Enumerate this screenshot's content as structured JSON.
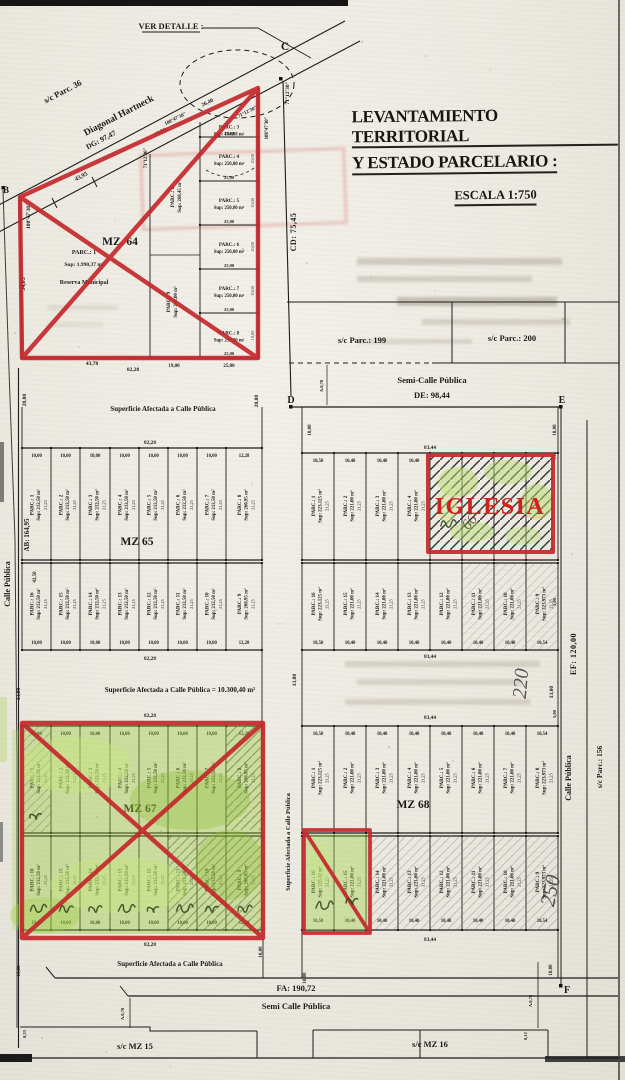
{
  "title": {
    "line1": "LEVANTAMIENTO TERRITORIAL",
    "line2": "Y ESTADO PARCELARIO :",
    "scale": "ESCALA 1:750"
  },
  "corners": {
    "b": "B",
    "c": "C",
    "d": "D",
    "e": "E",
    "f": "F"
  },
  "streets": {
    "ver_detalle": "VER DETALLE :",
    "sc_parc_36": "s/c Parc. 36",
    "diagonal_hartneck": "Diagonal Hartneck",
    "dg": "DG: 97,47",
    "cd": "CD: 75,45",
    "de_name": "Semi-Calle Pública",
    "de": "DE: 98,44",
    "ef": "EF: 120,00",
    "fa": "FA: 190,72",
    "fa_name": "Semi Calle Pública",
    "ab": "AB: 164,95",
    "calle_publica_left": "Calle Pública",
    "calle_publica_right": "Calle Pública",
    "sc_parc_156": "s/c Parc.: 156",
    "sc_parc_199": "s/c Parc.: 199",
    "sc_parc_200": "s/c Parc.: 200",
    "sc_mz_15": "s/c MZ 15",
    "sc_mz_16": "s/c MZ 16",
    "sup_calle_1": "Superficie Afectada a Calle Pública",
    "sup_calle_total": "Superficie Afectada a Calle Pública = 10.300,40 m²",
    "sup_calle_2": "Superficie Afectada a Calle Pública",
    "sup_calle_vert": "Superficie Afectada a Calle Pública"
  },
  "annotations": {
    "iglesia": "IGLESIA",
    "hw_220": "220",
    "hw_250": "250",
    "hw_66": "66"
  },
  "mz64": {
    "label": "MZ. 64",
    "parc1_name": "PARC.: 1",
    "parc1_sup": "Sup: 1.990,37 m²",
    "parc1_note": "Reserva Municipal",
    "strip_top": {
      "n": "PARC.: 2",
      "s": "Sup: 268,45 m²"
    },
    "strip_bottom": {
      "n": "PARC.: 9",
      "s": "Sup: 250,00 m²"
    },
    "column": [
      {
        "n": "PARC.: 3",
        "s": "Sup: 194,88 m²"
      },
      {
        "n": "PARC.: 4",
        "s": "Sup: 250,00 m²"
      },
      {
        "n": "PARC.: 5",
        "s": "Sup: 250,00 m²"
      },
      {
        "n": "PARC.: 6",
        "s": "Sup: 250,00 m²"
      },
      {
        "n": "PARC.: 7",
        "s": "Sup: 250,00 m²"
      },
      {
        "n": "PARC.: 8",
        "s": "Sup: 250,00 m²"
      }
    ],
    "width_label": "25,00",
    "depth_label": "10,00"
  },
  "blocks": {
    "mz65": {
      "label": "MZ 65",
      "height_label": "21,25",
      "top_total": "82,28",
      "bottom_total": "82,28",
      "rows": [
        {
          "widths": [
            "10,00",
            "10,00",
            "10,00",
            "10,00",
            "10,00",
            "10,00",
            "10,00",
            "12,28"
          ],
          "parcels": [
            {
              "n": "PARC.: 1",
              "s": "Sup: 212,50 m²"
            },
            {
              "n": "PARC.: 2",
              "s": "Sup: 212,50 m²"
            },
            {
              "n": "PARC.: 3",
              "s": "Sup: 212,50 m²"
            },
            {
              "n": "PARC.: 4",
              "s": "Sup: 212,50 m²"
            },
            {
              "n": "PARC.: 5",
              "s": "Sup: 212,50 m²"
            },
            {
              "n": "PARC.: 6",
              "s": "Sup: 212,50 m²"
            },
            {
              "n": "PARC.: 7",
              "s": "Sup: 212,50 m²"
            },
            {
              "n": "PARC.: 8",
              "s": "Sup: 260,95 m²"
            }
          ]
        },
        {
          "widths": [
            "10,00",
            "10,00",
            "10,00",
            "10,00",
            "10,00",
            "10,00",
            "10,00",
            "12,28"
          ],
          "parcels": [
            {
              "n": "PARC.: 16",
              "s": "Sup: 212,50 m²"
            },
            {
              "n": "PARC.: 15",
              "s": "Sup: 212,50 m²"
            },
            {
              "n": "PARC.: 14",
              "s": "Sup: 212,50 m²"
            },
            {
              "n": "PARC.: 13",
              "s": "Sup: 212,50 m²"
            },
            {
              "n": "PARC.: 12",
              "s": "Sup: 212,50 m²"
            },
            {
              "n": "PARC.: 11",
              "s": "Sup: 212,50 m²"
            },
            {
              "n": "PARC.: 10",
              "s": "Sup: 212,50 m²"
            },
            {
              "n": "PARC.: 9",
              "s": "Sup: 260,95 m²"
            }
          ]
        }
      ]
    },
    "mz66": {
      "label": "",
      "height_label": "21,25",
      "top_total": "83,44",
      "bottom_total": "83,44",
      "rows": [
        {
          "widths": [
            "10,50",
            "10,40",
            "10,40",
            "10,40"
          ],
          "parcels": [
            {
              "n": "PARC.: 1",
              "s": "Sup: 223,125 m²"
            },
            {
              "n": "PARC.: 2",
              "s": "Sup: 221,00 m²"
            },
            {
              "n": "PARC.: 3",
              "s": "Sup: 221,00 m²"
            },
            {
              "n": "PARC.: 4",
              "s": "Sup: 221,00 m²"
            },
            {
              "n": "",
              "s": ""
            },
            {
              "n": "",
              "s": ""
            },
            {
              "n": "",
              "s": ""
            },
            {
              "n": "",
              "s": ""
            }
          ]
        },
        {
          "widths": [
            "10,50",
            "10,40",
            "10,40",
            "10,40",
            "10,40",
            "10,40",
            "10,40",
            "10,54"
          ],
          "parcels": [
            {
              "n": "PARC.: 16",
              "s": "Sup: 223,125 m²"
            },
            {
              "n": "PARC.: 15",
              "s": "Sup: 221,00 m²"
            },
            {
              "n": "PARC.: 14",
              "s": "Sup: 221,00 m²"
            },
            {
              "n": "PARC.: 13",
              "s": "Sup: 221,00 m²"
            },
            {
              "n": "PARC.: 12",
              "s": "Sup: 221,00 m²"
            },
            {
              "n": "PARC.: 11",
              "s": "Sup: 221,00 m²"
            },
            {
              "n": "PARC.: 10",
              "s": "Sup: 221,00 m²"
            },
            {
              "n": "PARC.: 9",
              "s": "Sup: 223,973 m²"
            }
          ]
        }
      ]
    },
    "mz67": {
      "label": "MZ 67",
      "height_label": "21,25",
      "top_total": "82,28",
      "bottom_total": "82,28",
      "rows": [
        {
          "widths": [
            "10,00",
            "10,00",
            "10,00",
            "10,00",
            "10,00",
            "10,00",
            "10,00",
            "12,28"
          ],
          "parcels": [
            {
              "n": "PARC.: 1",
              "s": "Sup: 212,50 m²"
            },
            {
              "n": "PARC.: 2",
              "s": "Sup: 212,50 m²"
            },
            {
              "n": "PARC.: 3",
              "s": "Sup: 212,50 m²"
            },
            {
              "n": "PARC.: 4",
              "s": "Sup: 212,50 m²"
            },
            {
              "n": "PARC.: 5",
              "s": "Sup: 212,50 m²"
            },
            {
              "n": "PARC.: 6",
              "s": "Sup: 212,50 m²"
            },
            {
              "n": "PARC.: 7",
              "s": "Sup: 212,50 m²"
            },
            {
              "n": "PARC.: 8",
              "s": "Sup: 260,95 m²"
            }
          ]
        },
        {
          "widths": [
            "10,00",
            "10,00",
            "10,00",
            "10,00",
            "10,00",
            "10,00",
            "10,00",
            "12,28"
          ],
          "parcels": [
            {
              "n": "PARC.: 16",
              "s": "Sup: 212,50 m²"
            },
            {
              "n": "PARC.: 15",
              "s": "Sup: 212,50 m²"
            },
            {
              "n": "PARC.: 14",
              "s": "Sup: 212,50 m²"
            },
            {
              "n": "PARC.: 13",
              "s": "Sup: 212,50 m²"
            },
            {
              "n": "PARC.: 12",
              "s": "Sup: 212,50 m²"
            },
            {
              "n": "PARC.: 11",
              "s": "Sup: 212,50 m²"
            },
            {
              "n": "PARC.: 10",
              "s": "Sup: 212,50 m²"
            },
            {
              "n": "PARC.: 9",
              "s": "Sup: 260,95 m²"
            }
          ]
        }
      ]
    },
    "mz68": {
      "label": "MZ 68",
      "height_label": "21,25",
      "top_total": "83,44",
      "bottom_total": "83,44",
      "rows": [
        {
          "widths": [
            "10,50",
            "10,40",
            "10,40",
            "10,40",
            "10,40",
            "10,40",
            "10,40",
            "10,54"
          ],
          "parcels": [
            {
              "n": "PARC.: 1",
              "s": "Sup: 223,125 m²"
            },
            {
              "n": "PARC.: 2",
              "s": "Sup: 221,00 m²"
            },
            {
              "n": "PARC.: 3",
              "s": "Sup: 221,00 m²"
            },
            {
              "n": "PARC.: 4",
              "s": "Sup: 221,00 m²"
            },
            {
              "n": "PARC.: 5",
              "s": "Sup: 221,00 m²"
            },
            {
              "n": "PARC.: 6",
              "s": "Sup: 221,00 m²"
            },
            {
              "n": "PARC.: 7",
              "s": "Sup: 221,00 m²"
            },
            {
              "n": "PARC.: 8",
              "s": "Sup: 223,973 m²"
            }
          ]
        },
        {
          "widths": [
            "10,50",
            "10,40",
            "10,40",
            "10,40",
            "10,40",
            "10,40",
            "10,40",
            "10,54"
          ],
          "parcels": [
            {
              "n": "PARC.: 16",
              "s": "Sup: 223,12 m²"
            },
            {
              "n": "PARC.: 15",
              "s": "Sup: 221,00 m²"
            },
            {
              "n": "PARC.: 14",
              "s": "Sup: 221,00 m²"
            },
            {
              "n": "PARC.: 13",
              "s": "Sup: 221,00 m²"
            },
            {
              "n": "PARC.: 12",
              "s": "Sup: 221,00 m²"
            },
            {
              "n": "PARC.: 11",
              "s": "Sup: 221,00 m²"
            },
            {
              "n": "PARC.: 10",
              "s": "Sup: 221,00 m²"
            },
            {
              "n": "PARC.: 9",
              "s": "Sup: 223,973 m²"
            }
          ]
        }
      ]
    }
  },
  "dim_labels": [
    {
      "t": "43,95",
      "x": 82,
      "y": 178,
      "r": -27,
      "s": 6
    },
    {
      "t": "34,03",
      "x": 25,
      "y": 284,
      "r": -90,
      "s": 6
    },
    {
      "t": "108°47'30\"",
      "x": 30,
      "y": 216,
      "r": -90,
      "s": 5.5
    },
    {
      "t": "108°47'30\"",
      "x": 176,
      "y": 120,
      "r": -27,
      "s": 5
    },
    {
      "t": "108°47'30\"",
      "x": 268,
      "y": 128,
      "r": -90,
      "s": 4.8
    },
    {
      "t": "71°12'30\"",
      "x": 289,
      "y": 93,
      "r": -90,
      "s": 5.5
    },
    {
      "t": "71°12'30\"",
      "x": 248,
      "y": 113,
      "r": -27,
      "s": 5
    },
    {
      "t": "71°12'30\"",
      "x": 147,
      "y": 158,
      "r": -90,
      "s": 4.8
    },
    {
      "t": "26,40",
      "x": 208,
      "y": 104,
      "r": -27,
      "s": 5.5
    },
    {
      "t": "10,56",
      "x": 161,
      "y": 133,
      "r": -27,
      "s": 5
    },
    {
      "t": "43,78",
      "x": 92,
      "y": 365,
      "r": 0,
      "s": 5.5
    },
    {
      "t": "82,28",
      "x": 133,
      "y": 371,
      "r": 0,
      "s": 5.5
    },
    {
      "t": "25,00",
      "x": 229,
      "y": 367,
      "r": 0,
      "s": 5
    },
    {
      "t": "19,00",
      "x": 174,
      "y": 367,
      "r": 0,
      "s": 5
    },
    {
      "t": "20,00",
      "x": 26,
      "y": 400,
      "r": -90,
      "s": 5.5
    },
    {
      "t": "20,00",
      "x": 258,
      "y": 401,
      "r": -90,
      "s": 5.5
    },
    {
      "t": "A.0,78",
      "x": 323,
      "y": 386,
      "r": -90,
      "s": 4.5
    },
    {
      "t": "10,00",
      "x": 311,
      "y": 430,
      "r": -90,
      "s": 5
    },
    {
      "t": "10,00",
      "x": 556,
      "y": 430,
      "r": -90,
      "s": 5
    },
    {
      "t": "5,00",
      "x": 556,
      "y": 456,
      "r": -90,
      "s": 4.2
    },
    {
      "t": "13,00",
      "x": 296,
      "y": 680,
      "r": -90,
      "s": 5.5
    },
    {
      "t": "13,00",
      "x": 553,
      "y": 692,
      "r": -90,
      "s": 5.5
    },
    {
      "t": "13,00",
      "x": 20,
      "y": 694,
      "r": -90,
      "s": 5.5
    },
    {
      "t": "42,50",
      "x": 36,
      "y": 577,
      "r": -90,
      "s": 5
    },
    {
      "t": "5,00",
      "x": 556,
      "y": 602,
      "r": -90,
      "s": 4.5
    },
    {
      "t": "5,00",
      "x": 556,
      "y": 714,
      "r": -90,
      "s": 4.5
    },
    {
      "t": "10,00",
      "x": 20,
      "y": 971,
      "r": -90,
      "s": 5
    },
    {
      "t": "10,00",
      "x": 262,
      "y": 952,
      "r": -90,
      "s": 5
    },
    {
      "t": "10,00",
      "x": 306,
      "y": 978,
      "r": -90,
      "s": 5
    },
    {
      "t": "10,00",
      "x": 552,
      "y": 970,
      "r": -90,
      "s": 5
    },
    {
      "t": "A.0,78",
      "x": 124,
      "y": 1014,
      "r": -90,
      "s": 4.5
    },
    {
      "t": "0,33",
      "x": 26,
      "y": 1034,
      "r": -90,
      "s": 4.5
    },
    {
      "t": "A.0,78",
      "x": 532,
      "y": 1001,
      "r": -90,
      "s": 4.5
    },
    {
      "t": "0,12",
      "x": 527,
      "y": 1036,
      "r": -90,
      "s": 4.5
    }
  ]
}
